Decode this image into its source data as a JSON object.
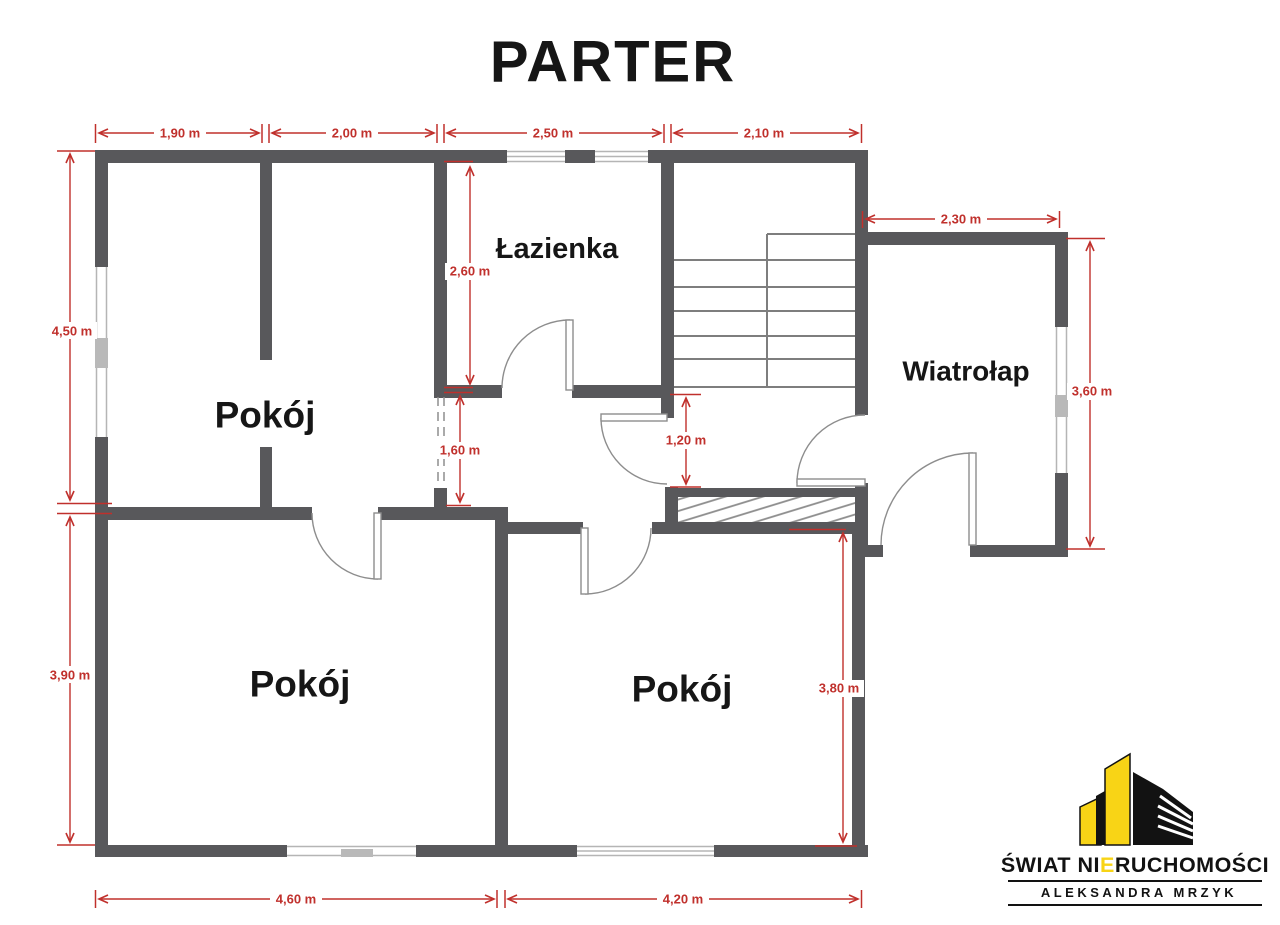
{
  "title": "PARTER",
  "rooms": {
    "room_top_left": "Pokój",
    "bathroom": "Łazienka",
    "vestibule": "Wiatrołap",
    "room_bottom_left": "Pokój",
    "room_bottom_middle": "Pokój"
  },
  "dims": {
    "top_1": "1,90 m",
    "top_2": "2,00 m",
    "top_3": "2,50 m",
    "top_4": "2,10 m",
    "left_upper": "4,50 m",
    "left_lower": "3,90 m",
    "vestibule_width": "2,30 m",
    "vestibule_height": "3,60 m",
    "bathroom_height": "2,60 m",
    "opening_width": "1,60 m",
    "hall_width": "1,20 m",
    "room_bm_height": "3,80 m",
    "bottom_1": "4,60 m",
    "bottom_2": "4,20 m"
  },
  "logo": {
    "brand_pre": "ŚWIAT NI",
    "brand_e": "E",
    "brand_post": "RUCHOMOŚCI",
    "person": "ALEKSANDRA MRZYK"
  },
  "colors": {
    "wall": "#58585b",
    "thin_line": "#7e7e7e",
    "dimension_red": "#c0302c",
    "logo_yellow": "#f8d416",
    "logo_black": "#121212"
  }
}
